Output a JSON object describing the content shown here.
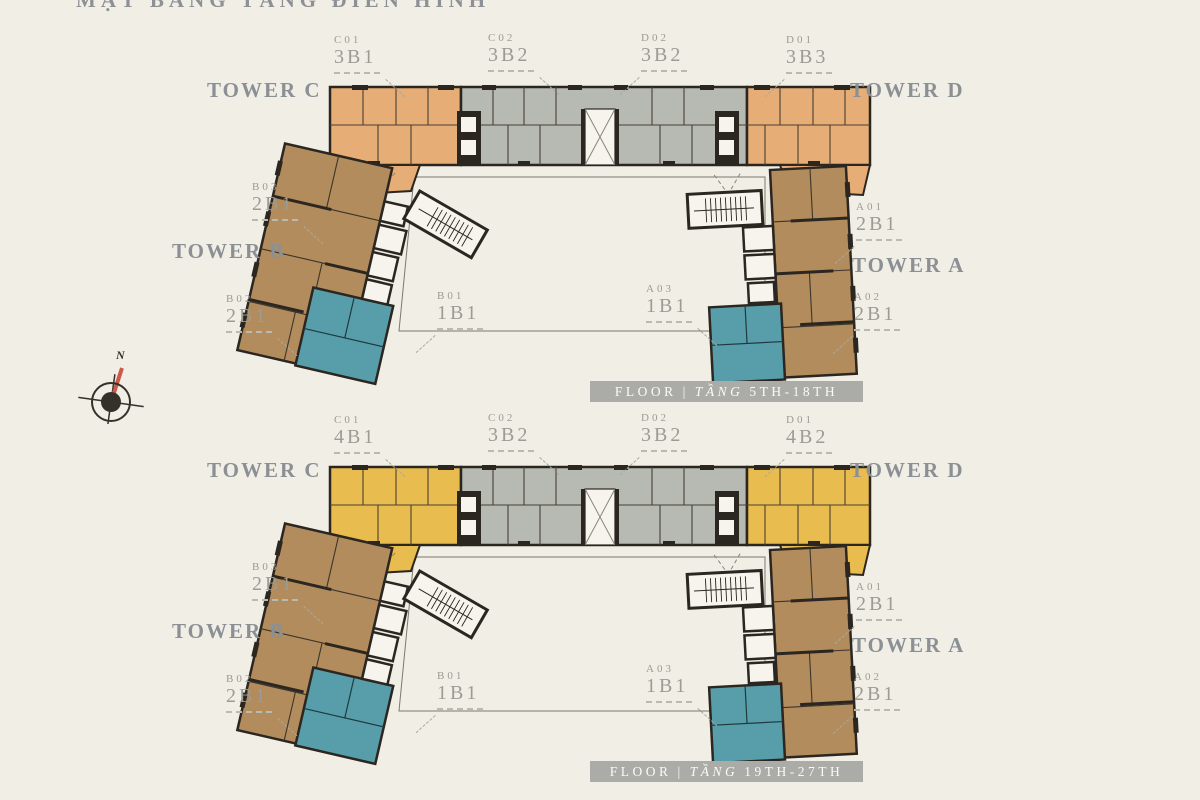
{
  "title": "MẶT BẰNG TẦNG ĐIỂN HÌNH",
  "compass": {
    "north_label": "N"
  },
  "colors": {
    "bg": "#f1eee5",
    "plan_orange": "#e6ad76",
    "plan_yellow": "#e9bc4f",
    "plan_gray": "#b7b9b3",
    "plan_brown": "#b28c5c",
    "plan_teal": "#579eaa",
    "outline": "#2b2620",
    "label_gray": "#9b9c94",
    "tower_gray": "#8b9095",
    "banner_bg": "#abaca8",
    "banner_text": "#fbfaf4",
    "compass_red": "#cd5949"
  },
  "plans": [
    {
      "floor_banner": {
        "floor": "FLOOR",
        "divider": "|",
        "tang": "TẦNG",
        "range": "5TH-18TH"
      },
      "towers": {
        "c": "TOWER C",
        "d": "TOWER D",
        "b": "TOWER B",
        "a": "TOWER A"
      },
      "units": [
        {
          "code": "C01",
          "type": "3B1"
        },
        {
          "code": "C02",
          "type": "3B2"
        },
        {
          "code": "D02",
          "type": "3B2"
        },
        {
          "code": "D01",
          "type": "3B3"
        },
        {
          "code": "B03",
          "type": "2B1"
        },
        {
          "code": "B02",
          "type": "2B1"
        },
        {
          "code": "B01",
          "type": "1B1"
        },
        {
          "code": "A01",
          "type": "2B1"
        },
        {
          "code": "A03",
          "type": "1B1"
        },
        {
          "code": "A02",
          "type": "2B1"
        }
      ]
    },
    {
      "floor_banner": {
        "floor": "FLOOR",
        "divider": "|",
        "tang": "TẦNG",
        "range": "19TH-27TH"
      },
      "towers": {
        "c": "TOWER C",
        "d": "TOWER D",
        "b": "TOWER B",
        "a": "TOWER A"
      },
      "units": [
        {
          "code": "C01",
          "type": "4B1"
        },
        {
          "code": "C02",
          "type": "3B2"
        },
        {
          "code": "D02",
          "type": "3B2"
        },
        {
          "code": "D01",
          "type": "4B2"
        },
        {
          "code": "B03",
          "type": "2B1"
        },
        {
          "code": "B02",
          "type": "2B1"
        },
        {
          "code": "B01",
          "type": "1B1"
        },
        {
          "code": "A01",
          "type": "2B1"
        },
        {
          "code": "A03",
          "type": "1B1"
        },
        {
          "code": "A02",
          "type": "2B1"
        }
      ]
    }
  ]
}
